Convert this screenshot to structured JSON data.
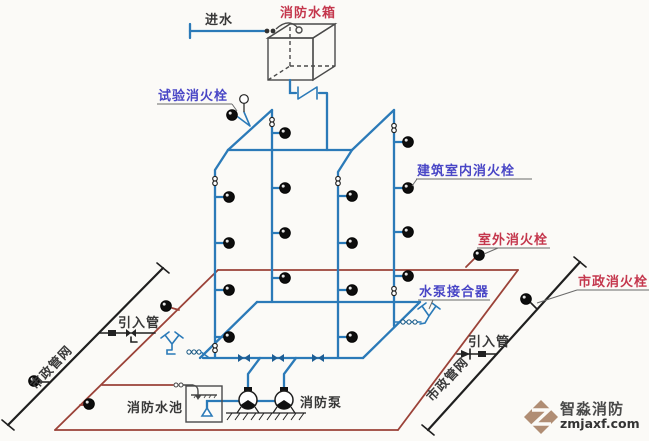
{
  "diagram": {
    "labels": {
      "water_inlet": "进水",
      "fire_water_tank": "消防水箱",
      "test_hydrant": "试验消火栓",
      "indoor_hydrant": "建筑室内消火栓",
      "outdoor_hydrant": "室外消火栓",
      "pump_adapter": "水泵接合器",
      "municipal_hydrant": "市政消火栓",
      "inlet_pipe_left": "引入管",
      "inlet_pipe_right": "引入管",
      "municipal_network_left": "市政管网",
      "municipal_network_right": "市政管网",
      "fire_water_pool": "消防水池",
      "fire_pump": "消防泵"
    },
    "watermark": {
      "brand": "智淼消防",
      "site": "zmjaxf.com"
    },
    "colors": {
      "indoor_pipe_blue": "#2b7ab8",
      "outdoor_ring_red": "#9b4238",
      "municipal_black": "#1f1f1f",
      "label_purple": "#4946c6",
      "label_red": "#c4374d",
      "watermark_tan": "#b08d74"
    }
  }
}
